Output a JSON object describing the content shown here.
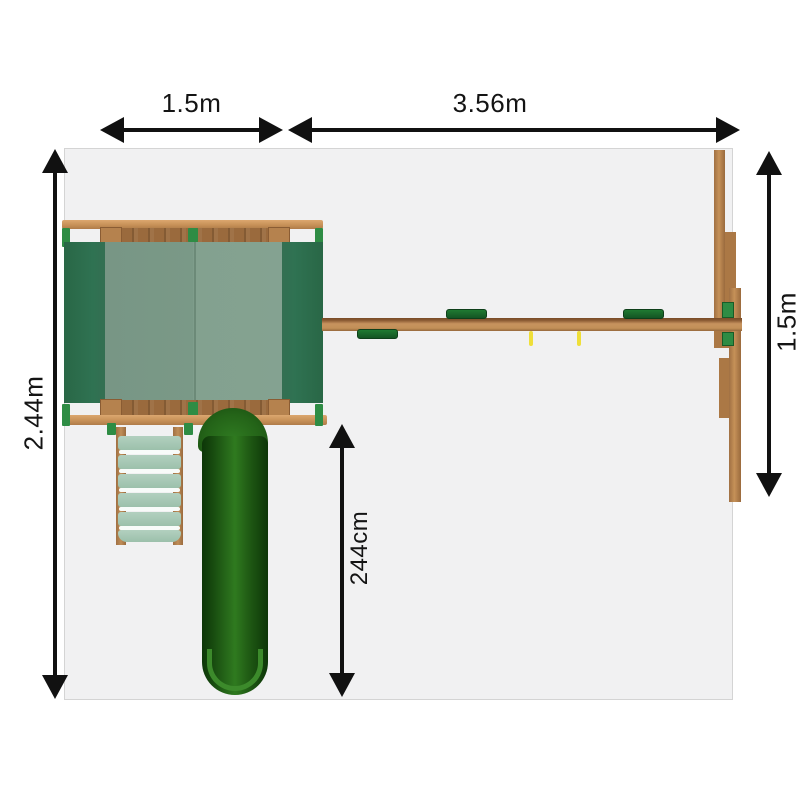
{
  "dimension_labels": {
    "footprint_width_left": "1.5m",
    "footprint_width_right": "3.56m",
    "footprint_depth": "2.44m",
    "aframe_depth": "1.5m",
    "slide_length": "244cm"
  },
  "diagram": {
    "type": "top-view dimension drawing",
    "subject": "climbing frame with canopy tower, tube slide, step ladder, swing beam and A-frame"
  },
  "colors": {
    "footprint_gray": "#f1f1f2",
    "wood_light": "#c79158",
    "wood_dark": "#9a6a3d",
    "canopy_dark_green": "#2d6f4f",
    "canopy_light_green": "#7f9e8c",
    "slide_dark_green": "#1d5512",
    "accent_green": "#2e8c44",
    "swing_seat_green": "#1a6e2e",
    "rope_yellow": "#efdf39",
    "dimension_black": "#141414"
  }
}
